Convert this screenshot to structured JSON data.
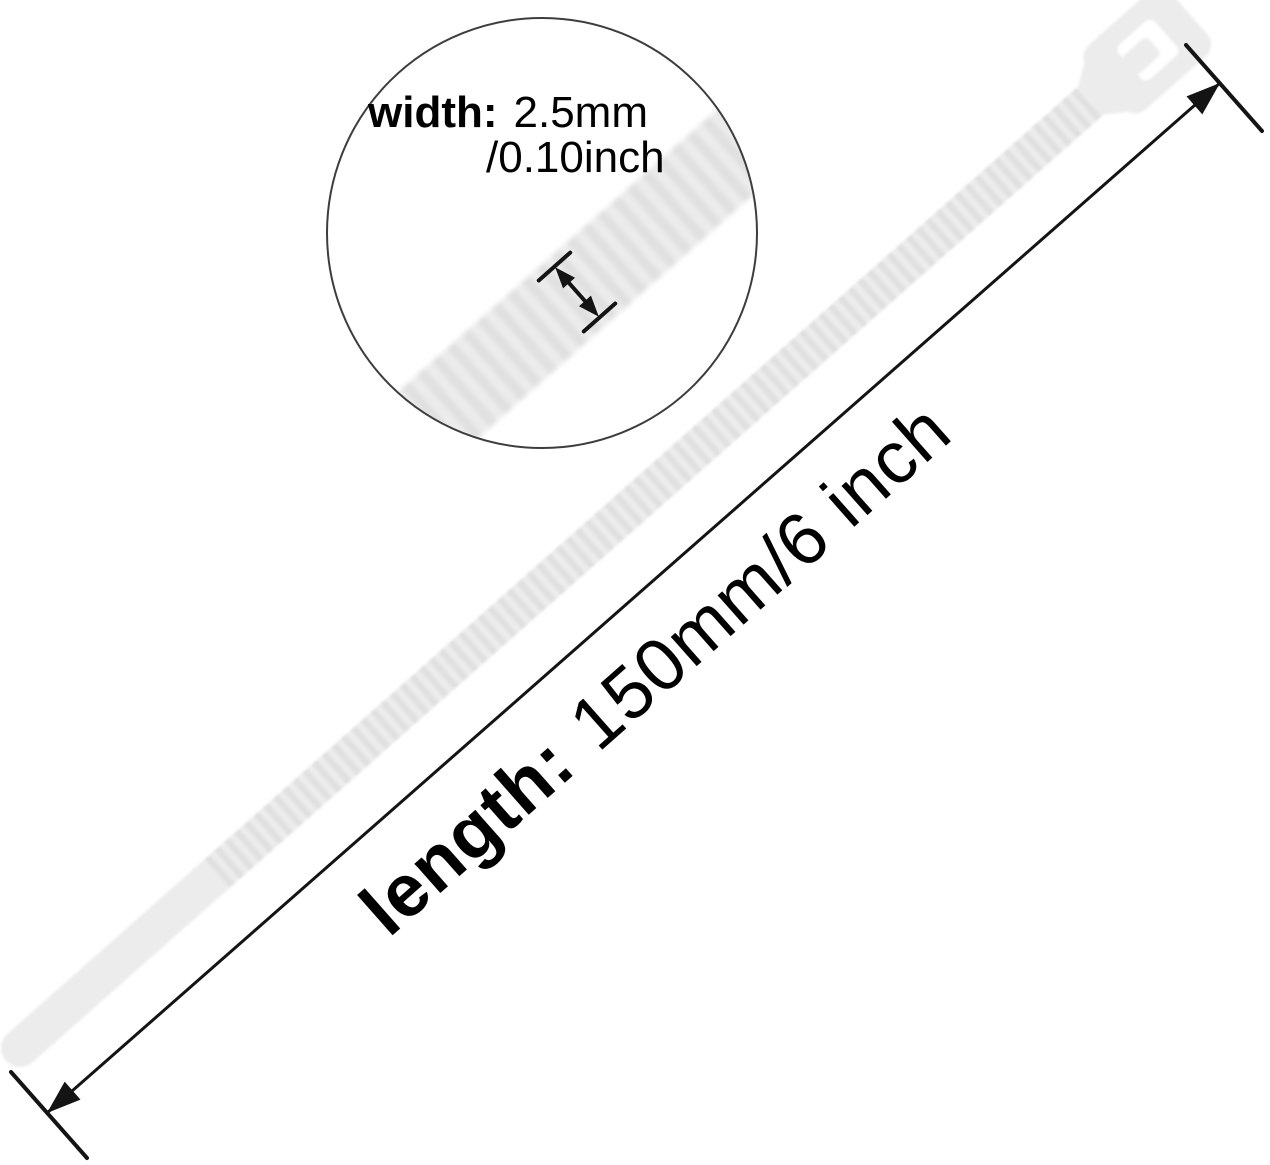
{
  "background": "#ffffff",
  "callouts": {
    "width": {
      "label": "width:",
      "metric_value": "2.5mm",
      "inch_value": "/0.10inch"
    },
    "length": {
      "label": "length:",
      "value": "150mm/6 inch"
    }
  },
  "colors": {
    "tie_fill": "#ececec",
    "tie_rib": "#e0e0e0",
    "slot_fill": "#ffffff",
    "line": "#141414",
    "circle_outline": "#3d3d3d",
    "text": "#000000"
  }
}
